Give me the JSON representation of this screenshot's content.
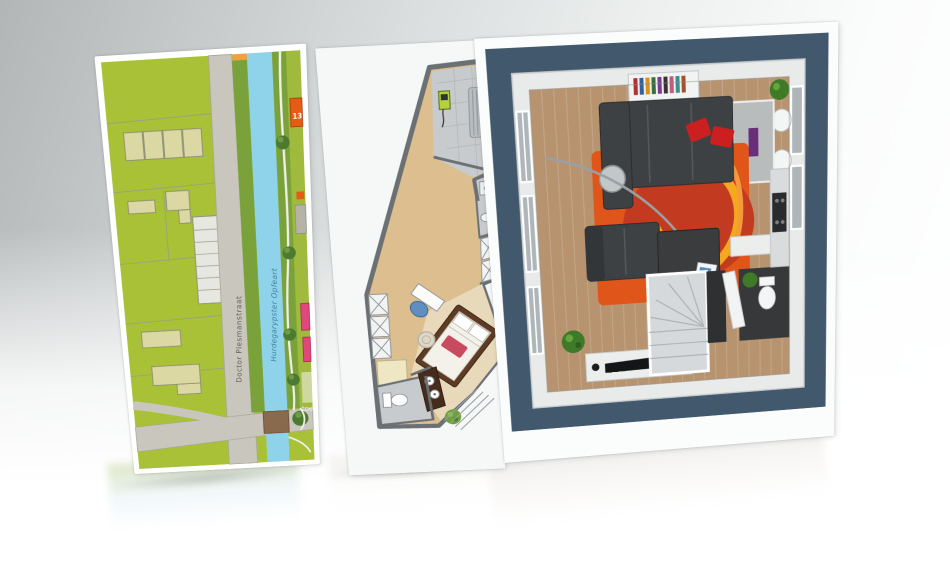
{
  "scene": {
    "bg_top_left": "#b2b6b7",
    "bg_bottom": "#ffffff"
  },
  "map_panel": {
    "house_number_label": "13",
    "road_label": "Doctor Plesmanstraat",
    "canal_label": "Hurdegarypster Opfeart",
    "partial_label": "toe",
    "colors": {
      "grass": "#a9c136",
      "bank": "#7ba23a",
      "road": "#c9c6bd",
      "water": "#8ed3ea",
      "building": "#dcd8a3",
      "garage": "#e6e7e0",
      "orange_house": "#e55c15",
      "orange_strip": "#f0a03c",
      "pink_house": "#e0487c",
      "tree": "#4b7a30",
      "bridge": "#8a6a4c"
    }
  },
  "floorplan2d_panel": {
    "colors": {
      "wall": "#6b7075",
      "wood": "#ddbe8e",
      "tile": "#c7cbcd",
      "carpet": "#e8d9ba",
      "bed_frame": "#5d3b25",
      "pillow_red": "#c84a5e",
      "chair_blue": "#5e8fc0",
      "vanity": "#472c1c",
      "door": "#efe6c4",
      "plant": "#6fa03c",
      "radiator": "#b9bec1",
      "meter": "#b6d23a"
    }
  },
  "floorplan3d_panel": {
    "colors": {
      "frame": "#42586c",
      "wall": "#e9ebeb",
      "wood": "#b7946f",
      "rug_base": "#e0551a",
      "rug_deep": "#c23a1f",
      "rug_ring": "#f5a71e",
      "rug_dot": "#f0c030",
      "sofa": "#3e4144",
      "cushion_red": "#cc2020",
      "table": "#3a3c3e",
      "stairs": "#d6d9db",
      "wc_floor": "#37383a",
      "counter": "#d9dbdc",
      "hob": "#2a2b2c",
      "plant": "#3e7a28",
      "dining_table": "#b9bcbd",
      "runner_purple": "#6a2d7a"
    }
  }
}
